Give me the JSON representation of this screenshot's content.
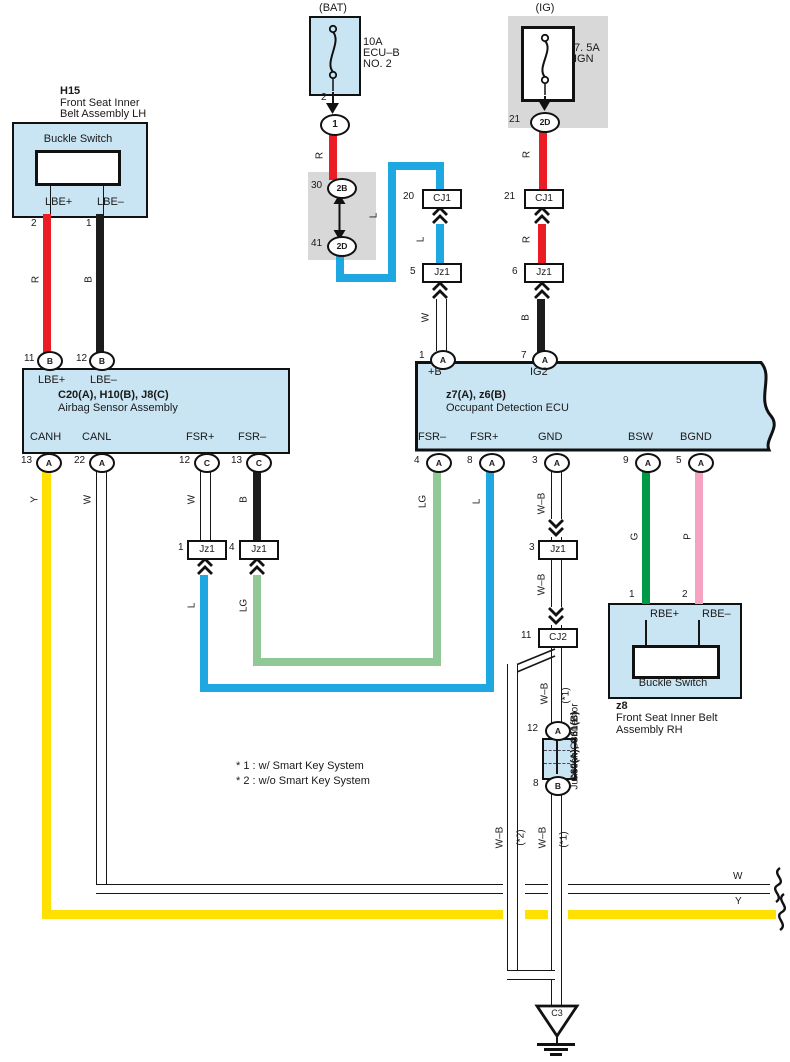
{
  "colors": {
    "component_fill": "#c9e5f3",
    "connector_gray": "#d8d8d8",
    "wire_red": "#ec1c24",
    "wire_blue": "#1ea7e0",
    "wire_yellow": "#ffe000",
    "wire_light_green": "#90c896",
    "wire_green": "#009a47",
    "wire_pink": "#f5a3c0",
    "wire_black": "#1c1c1c"
  },
  "fuses": {
    "bat": {
      "tag": "(BAT)",
      "rating": "10A",
      "name_lines": [
        "ECU–B",
        "NO. 2"
      ],
      "pin": "2",
      "conn": "1"
    },
    "ig": {
      "tag": "(IG)",
      "rating": "7. 5A",
      "name_lines": [
        "IGN"
      ],
      "pin": "21",
      "conn": "2D"
    }
  },
  "relay": {
    "top_num": "30",
    "top_conn": "2B",
    "bot_num": "41",
    "bot_conn": "2D"
  },
  "connectors": {
    "cj1_left": {
      "num": "20",
      "label": "CJ1"
    },
    "jz1_5": {
      "num": "5",
      "label": "Jz1"
    },
    "cj1_right": {
      "num": "21",
      "label": "CJ1"
    },
    "jz1_6": {
      "num": "6",
      "label": "Jz1"
    },
    "jz1_1": {
      "num": "1",
      "label": "Jz1"
    },
    "jz1_4": {
      "num": "4",
      "label": "Jz1"
    },
    "jz1_3": {
      "num": "3",
      "label": "Jz1"
    },
    "cj2": {
      "num": "11",
      "label": "CJ2"
    },
    "junction": {
      "top_num": "12",
      "top_letter": "A",
      "bot_num": "8",
      "bot_letter": "B",
      "code": "C60(A), C61(B)",
      "name": "Junction Connector"
    }
  },
  "h15": {
    "code": "H15",
    "name_lines": [
      "Front Seat Inner",
      "Belt Assembly LH"
    ],
    "switch": "Buckle Switch",
    "pin_labels": [
      "LBE+",
      "LBE–"
    ],
    "pin_nums": [
      "2",
      "1"
    ]
  },
  "airbag": {
    "code": "C20(A), H10(B), J8(C)",
    "name": "Airbag Sensor Assembly",
    "top_labels": [
      "LBE+",
      "LBE–"
    ],
    "top_pins": [
      {
        "num": "11",
        "letter": "B"
      },
      {
        "num": "12",
        "letter": "B"
      }
    ],
    "bottom_labels": [
      "CANH",
      "CANL",
      "FSR+",
      "FSR–"
    ],
    "bottom_pins": [
      {
        "num": "13",
        "letter": "A"
      },
      {
        "num": "22",
        "letter": "A"
      },
      {
        "num": "12",
        "letter": "C"
      },
      {
        "num": "13",
        "letter": "C"
      }
    ]
  },
  "ecu": {
    "code": "z7(A), z6(B)",
    "name": "Occupant Detection ECU",
    "top_labels": [
      "+B",
      "IG2"
    ],
    "top_pins": [
      {
        "num": "1",
        "letter": "A"
      },
      {
        "num": "7",
        "letter": "A"
      }
    ],
    "bottom_labels": [
      "FSR–",
      "FSR+",
      "GND",
      "BSW",
      "BGND"
    ],
    "bottom_pins": [
      {
        "num": "4",
        "letter": "A"
      },
      {
        "num": "8",
        "letter": "A"
      },
      {
        "num": "3",
        "letter": "A"
      },
      {
        "num": "9",
        "letter": "A"
      },
      {
        "num": "5",
        "letter": "A"
      }
    ]
  },
  "z8": {
    "code": "z8",
    "name_lines": [
      "Front Seat Inner Belt",
      "Assembly RH"
    ],
    "switch": "Buckle Switch",
    "pin_labels": [
      "RBE+",
      "RBE–"
    ],
    "pin_nums": [
      "1",
      "2"
    ]
  },
  "wire_labels": {
    "r": "R",
    "b": "B",
    "w": "W",
    "l": "L",
    "lg": "LG",
    "y": "Y",
    "wb": "W–B",
    "g": "G",
    "p": "P",
    "star1": "(*1)",
    "star2": "(*2)"
  },
  "notes": [
    "* 1 : w/ Smart Key System",
    "* 2 : w/o Smart Key System"
  ],
  "ground": {
    "label": "C3"
  }
}
